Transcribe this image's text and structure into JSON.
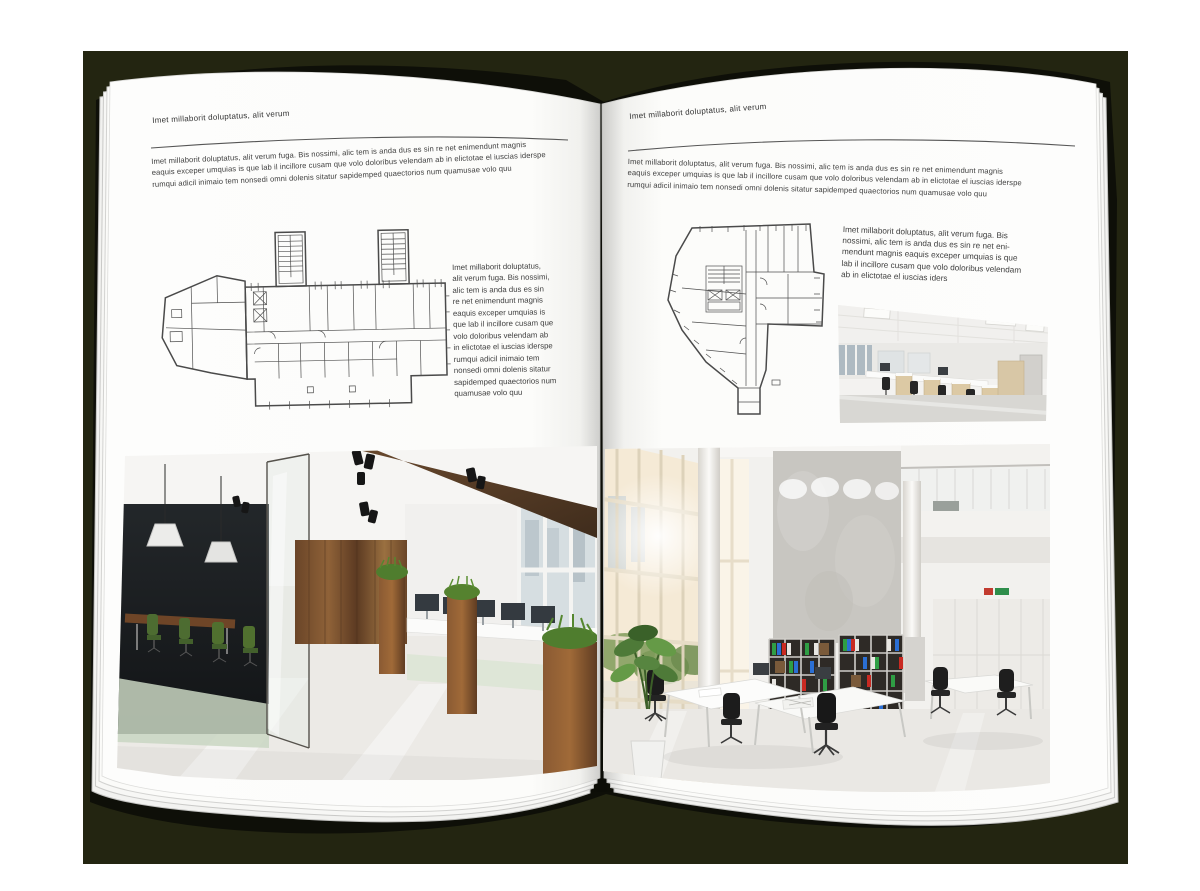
{
  "mockup_title": "open-magazine-spread-office-interior-brochure",
  "left_page": {
    "header": "Imet millaborit doluptatus, alit verum",
    "intro": "Imet millaborit doluptatus, alit verum fuga. Bis nossimi, alic tem is anda dus es sin re net enimendunt magnis\neaquis exceper umquias is que lab il incillore cusam que volo doloribus velendam ab in elictotae el iuscias iderspe\nrumqui adicil inimaio tem nonsedi omni dolenis sitatur sapidemped quaectorios num quamusae volo quu",
    "caption": "Imet millaborit doluptatus,\nalit verum fuga. Bis nossimi,\nalic tem is anda dus es sin\nre net enimendunt magnis\neaquis exceper umquias is\nque lab il incillore cusam que\nvolo doloribus velendam ab\nin elictotae el iuscias iderspe\nrumqui adicil inimaio tem\nnonsedi omni dolenis sitatur\nsapidemped quaectorios num\nquamusae volo quu"
  },
  "right_page": {
    "header": "Imet millaborit doluptatus, alit verum",
    "intro": "Imet millaborit doluptatus, alit verum fuga. Bis nossimi, alic tem is anda dus es sin re net enimendunt magnis\neaquis exceper umquias is que lab il incillore cusam que volo doloribus velendam ab in elictotae el iuscias iderspe\nrumqui adicil inimaio tem nonsedi omni dolenis sitatur sapidemped quaectorios num quamusae volo quu",
    "caption": "Imet millaborit doluptatus, alit verum fuga. Bis\nnossimi, alic tem is anda dus es sin re net eni-\nmendunt magnis eaquis exceper umquias is que\nlab il incillore cusam que volo doloribus velendam\nab in elictotae el iuscias iders"
  },
  "palette": {
    "backdrop": "#232511",
    "book_silhouette": "#0e0f08",
    "page": "#fdfdfc",
    "text": "#3e3e3e",
    "wood_wall": "#7a5230",
    "plant_green": "#4e7a38",
    "binder_green": "#2f9e44",
    "binder_blue": "#2b6fd4",
    "binder_red": "#c92a22"
  }
}
